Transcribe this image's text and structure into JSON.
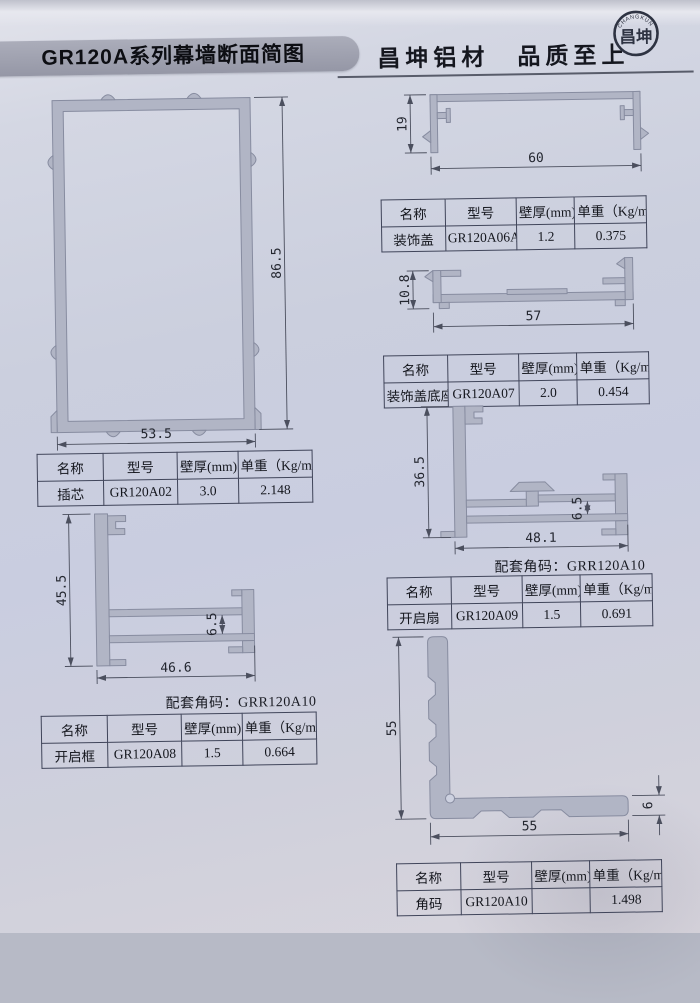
{
  "header": {
    "title": "GR120A系列幕墙断面简图",
    "brand": "昌坤铝材　品质至上",
    "logo_cn": "昌坤",
    "logo_en": "CHANGKUN"
  },
  "table_headers": {
    "name": "名称",
    "model": "型号",
    "thickness": "壁厚(mm)",
    "weight": "单重（Kg/m）"
  },
  "note_label": "配套角码：GRR120A10",
  "profiles": {
    "chaxin": {
      "name": "插芯",
      "model": "GR120A02",
      "thickness": "3.0",
      "weight": "2.148",
      "dim_h": "86.5",
      "dim_w": "53.5"
    },
    "zsg": {
      "name": "装饰盖",
      "model": "GR120A06A",
      "thickness": "1.2",
      "weight": "0.375",
      "dim_h": "19",
      "dim_w": "60"
    },
    "zsgdz": {
      "name": "装饰盖底座",
      "model": "GR120A07",
      "thickness": "2.0",
      "weight": "0.454",
      "dim_h": "10.8",
      "dim_w": "57"
    },
    "kqs": {
      "name": "开启扇",
      "model": "GR120A09",
      "thickness": "1.5",
      "weight": "0.691",
      "dim_h": "36.5",
      "dim_gap": "6.5",
      "dim_w": "48.1"
    },
    "kqk": {
      "name": "开启框",
      "model": "GR120A08",
      "thickness": "1.5",
      "weight": "0.664",
      "dim_h": "45.5",
      "dim_gap": "6.5",
      "dim_w": "46.6"
    },
    "jm": {
      "name": "角码",
      "model": "GR120A10",
      "thickness": "",
      "weight": "1.498",
      "dim_h": "55",
      "dim_w": "55",
      "dim_t": "6"
    }
  }
}
